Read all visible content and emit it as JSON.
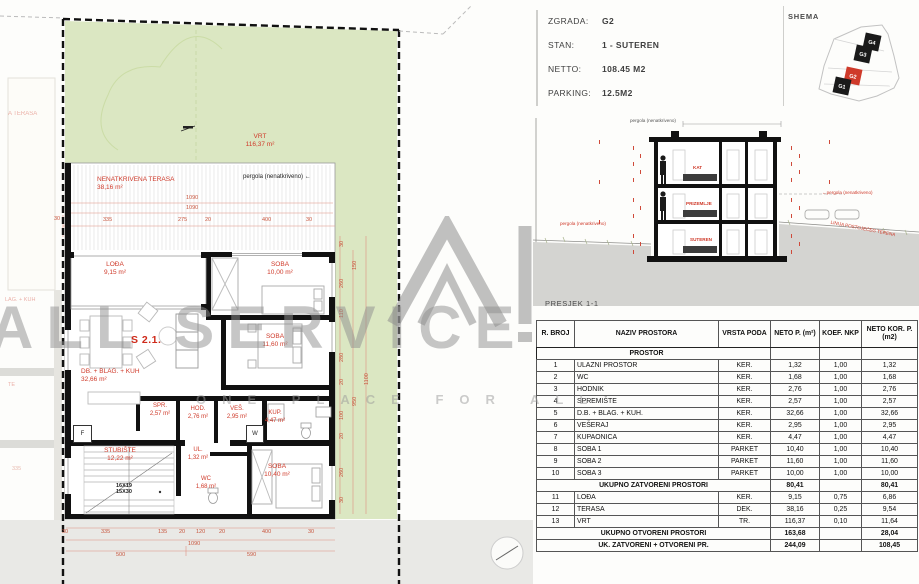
{
  "watermark": {
    "line1": "ALL SERVICE",
    "line2": "ONE PLACE FOR ALL"
  },
  "info": {
    "rows": [
      {
        "label": "ZGRADA:",
        "value": "G2"
      },
      {
        "label": "STAN:",
        "value": "1 - SUTEREN"
      },
      {
        "label": "NETTO:",
        "value": "108.45 M2"
      },
      {
        "label": "PARKING:",
        "value": "12.5M2"
      }
    ]
  },
  "shema": {
    "title": "SHEMA",
    "units": [
      "G4",
      "G3",
      "G2",
      "G1"
    ],
    "highlight": "G2",
    "highlight_color": "#cf3a2a"
  },
  "plan": {
    "vrt": {
      "name": "VRT",
      "area": "116,37 m²"
    },
    "terasa": {
      "name": "NENATKRIVENA TERASA",
      "area": "38,16 m²"
    },
    "pergola": "pergola (nenatkriveno) ←",
    "unit": "S 2.1.",
    "rooms": {
      "loda": {
        "name": "LOĐA",
        "area": "9,15 m²"
      },
      "soba1": {
        "name": "SOBA",
        "area": "10,00 m²"
      },
      "dnevni": {
        "name": "DB. + BLAG. + KUH",
        "area": "32,66 m²"
      },
      "soba2": {
        "name": "SOBA",
        "area": "11,60 m²"
      },
      "spr": {
        "name": "SPR.",
        "area": "2,57 m²"
      },
      "hod": {
        "name": "HOD.",
        "area": "2,76 m²"
      },
      "ves": {
        "name": "VEŠ.",
        "area": "2,95 m²"
      },
      "kup": {
        "name": "KUP.",
        "area": "4,47 m²"
      },
      "stubiste": {
        "name": "STUBIŠTE",
        "area": "12,22 m²"
      },
      "ul": {
        "name": "UL.",
        "area": "1,32 m²"
      },
      "wc": {
        "name": "WC",
        "area": "1,68 m²"
      },
      "soba3": {
        "name": "SOBA",
        "area": "10,40 m²"
      }
    },
    "stair_note": [
      "16X19",
      "15X30"
    ],
    "appliances": {
      "f": "F",
      "w": "W"
    },
    "dims_top": [
      "1090",
      "1090",
      "30",
      "335",
      "275",
      "20",
      "400",
      "30"
    ],
    "dims_bottom": [
      "30",
      "335",
      "135",
      "20",
      "120",
      "20",
      "400",
      "30",
      "1090",
      "500",
      "590"
    ],
    "dims_right": [
      "30",
      "260",
      "110",
      "280",
      "20",
      "100",
      "20",
      "260",
      "30",
      "150",
      "950",
      "1100"
    ],
    "neighbor": {
      "t1": "A TERASA",
      "t2": "LAG. + KUH",
      "t3": "TE",
      "d1": "335"
    }
  },
  "section": {
    "caption": "PRESJEK 1-1",
    "floors": [
      "KAT",
      "PRIZEMLJE",
      "SUTEREN"
    ],
    "pergola_top": "pergola (nenatkriveno)",
    "pergola_right": "←pergola (nenatkriveno)",
    "pergola_bottom": "pergola (nenatkriveno)",
    "terrain": "LINIJA POSTOJEĆEG TERENA"
  },
  "table": {
    "headers": [
      "R. BROJ",
      "NAZIV PROSTORA",
      "VRSTA PODA",
      "NETO P. (m²)",
      "KOEF. NKP",
      "NETO KOR. P. (m2)"
    ],
    "group": "PROSTOR",
    "rows": [
      [
        "1",
        "ULAZNI PROSTOR",
        "KER.",
        "1,32",
        "1,00",
        "1,32"
      ],
      [
        "2",
        "WC",
        "KER.",
        "1,68",
        "1,00",
        "1,68"
      ],
      [
        "3",
        "HODNIK",
        "KER.",
        "2,76",
        "1,00",
        "2,76"
      ],
      [
        "4",
        "SPREMIŠTE",
        "KER.",
        "2,57",
        "1,00",
        "2,57"
      ],
      [
        "5",
        "D.B. + BLAG. + KUH.",
        "KER.",
        "32,66",
        "1,00",
        "32,66"
      ],
      [
        "6",
        "VEŠERAJ",
        "KER.",
        "2,95",
        "1,00",
        "2,95"
      ],
      [
        "7",
        "KUPAONICA",
        "KER.",
        "4,47",
        "1,00",
        "4,47"
      ],
      [
        "8",
        "SOBA 1",
        "PARKET",
        "10,40",
        "1,00",
        "10,40"
      ],
      [
        "9",
        "SOBA 2",
        "PARKET",
        "11,60",
        "1,00",
        "11,60"
      ],
      [
        "10",
        "SOBA 3",
        "PARKET",
        "10,00",
        "1,00",
        "10,00"
      ]
    ],
    "subtotal_closed": {
      "label": "UKUPNO ZATVORENI PROSTORI",
      "neto": "80,41",
      "kor": "80,41"
    },
    "rows_open": [
      [
        "11",
        "LOĐA",
        "KER.",
        "9,15",
        "0,75",
        "6,86"
      ],
      [
        "12",
        "TERASA",
        "DEK.",
        "38,16",
        "0,25",
        "9,54"
      ],
      [
        "13",
        "VRT",
        "TR.",
        "116,37",
        "0,10",
        "11,64"
      ]
    ],
    "subtotal_open": {
      "label": "UKUPNO OTVORENI PROSTORI",
      "neto": "163,68",
      "kor": "28,04"
    },
    "total": {
      "label": "UK. ZATVORENI + OTVORENI PR.",
      "neto": "244,09",
      "kor": "108,45"
    }
  }
}
